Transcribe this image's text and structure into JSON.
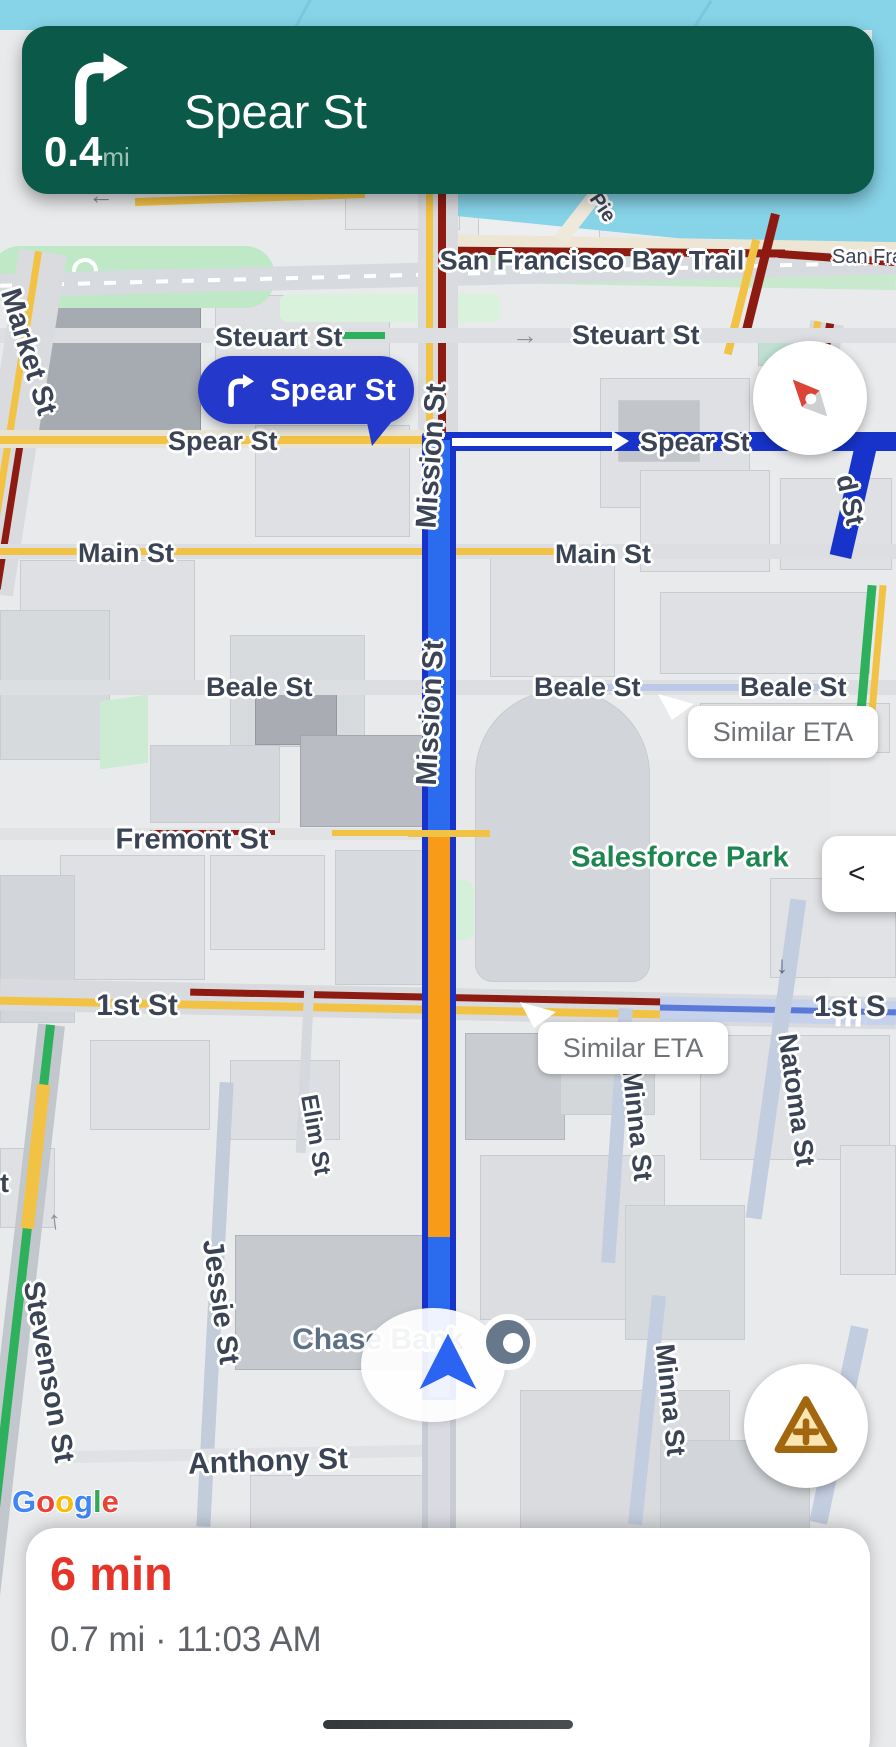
{
  "banner": {
    "distance": "0.4",
    "distance_unit": "mi",
    "instruction": "Spear St"
  },
  "map": {
    "labels": {
      "market_st": "Market St",
      "steuart_st_left": "Steuart St",
      "steuart_st_right": "Steuart St",
      "spear_st_left": "Spear St",
      "spear_st_right": "Spear St",
      "d_st_partial": "d St",
      "main_st_left": "Main St",
      "main_st_right": "Main St",
      "beale_st_left": "Beale St",
      "beale_st_mid": "Beale St",
      "beale_st_right": "Beale St",
      "mission_st_1": "Mission St",
      "mission_st_2": "Mission St",
      "fremont_st": "Fremont St",
      "first_st_left": "1st St",
      "first_st_right": "1st S",
      "natoma_st": "Natoma St",
      "minna_st_1": "Minna St",
      "minna_st_2": "Minna St",
      "elim_st": "Elim St",
      "stevenson_st": "Stevenson St",
      "jessie_st": "Jessie St",
      "anthony_st": "Anthony St",
      "t_partial": "t",
      "pier_partial": "Pie",
      "bay_trail": "San Francisco Bay Trail",
      "san_fran_partial": "San Fran"
    },
    "poi": {
      "salesforce_park": "Salesforce Park",
      "chase_bank": "Chase Bank"
    },
    "bubbles": {
      "next_turn": "Spear St",
      "eta_note_1": "Similar ETA",
      "eta_note_2": "Similar ETA"
    },
    "attribution": {
      "letters": [
        {
          "ch": "G",
          "color": "#4285F4"
        },
        {
          "ch": "o",
          "color": "#EA4335"
        },
        {
          "ch": "o",
          "color": "#FBBC05"
        },
        {
          "ch": "g",
          "color": "#4285F4"
        },
        {
          "ch": "l",
          "color": "#34A853"
        },
        {
          "ch": "e",
          "color": "#EA4335"
        }
      ]
    }
  },
  "controls": {
    "collapse_label": "<"
  },
  "bottom_sheet": {
    "eta": "6 min",
    "details": "0.7 mi · 11:03 AM"
  },
  "colors": {
    "banner_green": "#0B5A49",
    "route_border_blue": "#1733C9",
    "route_fill_blue": "#2B6CEF",
    "traffic_orange": "#F79B18",
    "traffic_yellow": "#F2C245",
    "traffic_dark_red": "#8E1B12",
    "traffic_green": "#2EB05C",
    "eta_red": "#E5352B",
    "water_blue": "#87D3E8"
  }
}
